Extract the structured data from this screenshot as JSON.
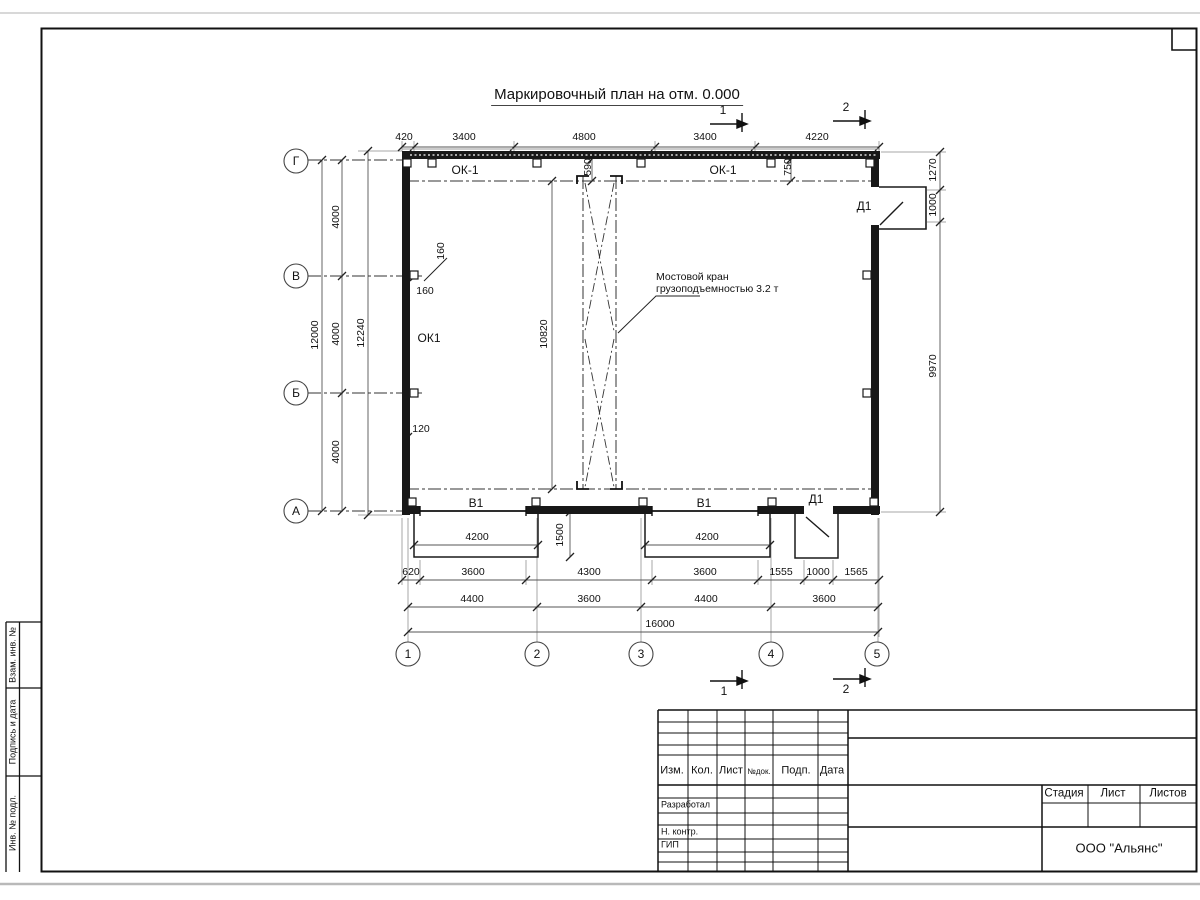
{
  "sheet": {
    "title": "Маркировочный план на отм. 0.000",
    "company": "ООО \"Альянс\"",
    "side_labels": [
      "Взам. инв. №",
      "Подпись и дата",
      "Инв. № подл."
    ],
    "title_block": {
      "header_cols": [
        "Изм.",
        "Кол.",
        "Лист",
        "№док.",
        "Подп.",
        "Дата"
      ],
      "row_labels": [
        "Разработал",
        "Н. контр.",
        "ГИП"
      ],
      "stage_cols": [
        "Стадия",
        "Лист",
        "Листов"
      ]
    }
  },
  "plan": {
    "axes_rows": [
      "Г",
      "В",
      "Б",
      "А"
    ],
    "axes_cols": [
      "1",
      "2",
      "3",
      "4",
      "5"
    ],
    "section_marks_top": [
      "1",
      "2"
    ],
    "section_marks_bottom": [
      "1",
      "2"
    ],
    "window_labels": [
      "ОК-1",
      "ОК-1",
      "ОК1"
    ],
    "gate_labels": [
      "В1",
      "В1"
    ],
    "door_labels": [
      "Д1",
      "Д1"
    ],
    "crane_note": [
      "Мостовой кран",
      "грузоподъемностью 3.2 т"
    ],
    "dims": {
      "top": [
        "420",
        "3400",
        "4800",
        "3400",
        "4220"
      ],
      "left": [
        "12000",
        "4000",
        "4000",
        "4000",
        "12240"
      ],
      "right": [
        "1270",
        "1000",
        "9970"
      ],
      "bottom_gate": [
        "4200",
        "4200",
        "1500"
      ],
      "bottom_row1": [
        "620",
        "3600",
        "4300",
        "3600",
        "1555",
        "1000",
        "1565"
      ],
      "bottom_row2": [
        "4400",
        "3600",
        "4400",
        "3600"
      ],
      "bottom_total": [
        "16000"
      ],
      "inner": [
        "10820",
        "590",
        "750",
        "160",
        "160",
        "120"
      ]
    }
  }
}
